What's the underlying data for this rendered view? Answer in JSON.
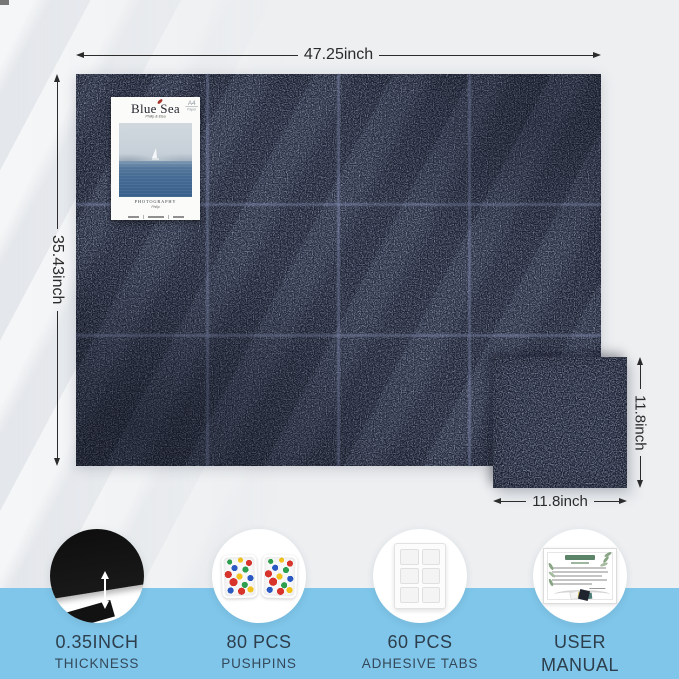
{
  "dimensions": {
    "board_width_label": "47.25inch",
    "board_height_label": "35.43inch",
    "tile_height_label": "11.8inch",
    "tile_width_label": "11.8inch"
  },
  "poster": {
    "title": "Blue Sea",
    "subtitle": "Philip & Elsa",
    "corner_mark": "A4",
    "corner_mark_sub": "Paper",
    "caption": "PHOTOGRAPHY",
    "caption_sub": "Philip"
  },
  "features": [
    {
      "icon": "thickness-tile-icon",
      "value": "0.35INCH",
      "label": "THICKNESS"
    },
    {
      "icon": "pushpins-icon",
      "value": "80 PCS",
      "label": "PUSHPINS"
    },
    {
      "icon": "adhesive-tabs-icon",
      "value": "60 PCS",
      "label": "ADHESIVE TABS"
    },
    {
      "icon": "user-manual-icon",
      "value": "USER",
      "label": "MANUAL"
    }
  ],
  "colors": {
    "board_navy": "#1c2234",
    "grid_line": "#7c86aa",
    "band_blue": "#7fc6ea",
    "label_text": "#2d3e4c",
    "leaf_red": "#a5352c"
  }
}
